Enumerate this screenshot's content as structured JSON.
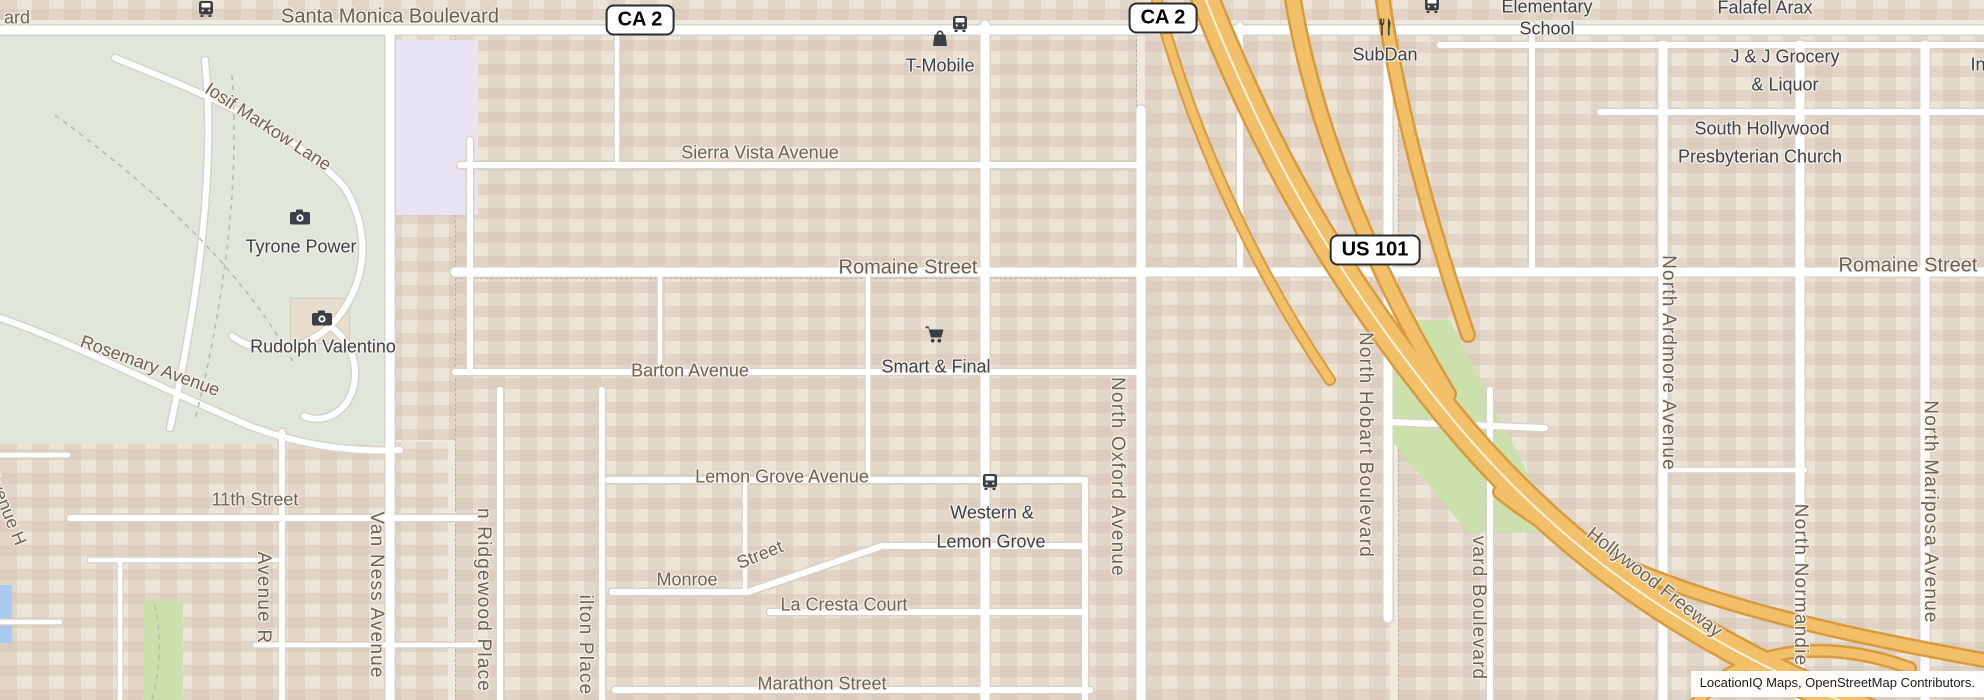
{
  "attribution": "LocationIQ Maps, OpenStreetMap Contributors.",
  "shields": {
    "ca2_left": "CA 2",
    "ca2_right": "CA 2",
    "us101": "US 101"
  },
  "labels": {
    "ard_partial": "ard",
    "santa_monica": "Santa Monica Boulevard",
    "sierra_vista": "Sierra Vista Avenue",
    "romaine_center": "Romaine Street",
    "romaine_right": "Romaine Street",
    "barton": "Barton Avenue",
    "lemon_grove": "Lemon Grove Avenue",
    "monroe": "Monroe",
    "monroe_street_word": "Street",
    "la_cresta": "La Cresta Court",
    "marathon": "Marathon Street",
    "eleventh": "11th Street",
    "avenue_r": "Avenue R",
    "avenue_h": "Avenue H",
    "van_ness": "Van Ness Avenue",
    "ridgewood": "n Ridgewood Place",
    "wilton": "ilton Place",
    "oxford": "North Oxford Avenue",
    "hobart": "North Hobart Boulevard",
    "harvard": "vard Boulevard",
    "ardmore": "North Ardmore Avenue",
    "normandie": "North Normandie",
    "mariposa": "North Mariposa Avenue",
    "hollywood_freeway": "Hollywood Freeway",
    "iosif_markow": "Iosif Markow Lane",
    "rosemary": "Rosemary Avenue",
    "in_partial": "In"
  },
  "pois": {
    "t_mobile": "T-Mobile",
    "subdan": "SubDan",
    "smart_final": "Smart & Final",
    "tyrone_power": "Tyrone Power",
    "rudolph_valentino": "Rudolph Valentino",
    "western_line1": "Western &",
    "western_line2": "Lemon Grove",
    "elementary_line1": "Elementary",
    "elementary_line2": "School",
    "falafel": "Falafel Arax",
    "jj_line1": "J & J Grocery",
    "jj_line2": "& Liquor",
    "church_line1": "South Hollywood",
    "church_line2": "Presbyterian Church"
  },
  "icons": {
    "bus": "bus-icon",
    "camera": "camera-icon",
    "shopping_bag": "shopping-bag-icon",
    "restaurant": "restaurant-icon",
    "shopping_cart": "shopping-cart-icon"
  },
  "colors": {
    "freeway": "#f3c06a",
    "freeway_casing": "#d89a3c",
    "road": "#ffffff",
    "road_casing": "#d8d2c7",
    "cemetery": "#e1e6da",
    "grass": "#cbe0ab",
    "water": "#a9c9ee",
    "school_grounds": "#e9e4f4",
    "street_label": "#6e6355",
    "poi_label": "#3f414a"
  }
}
